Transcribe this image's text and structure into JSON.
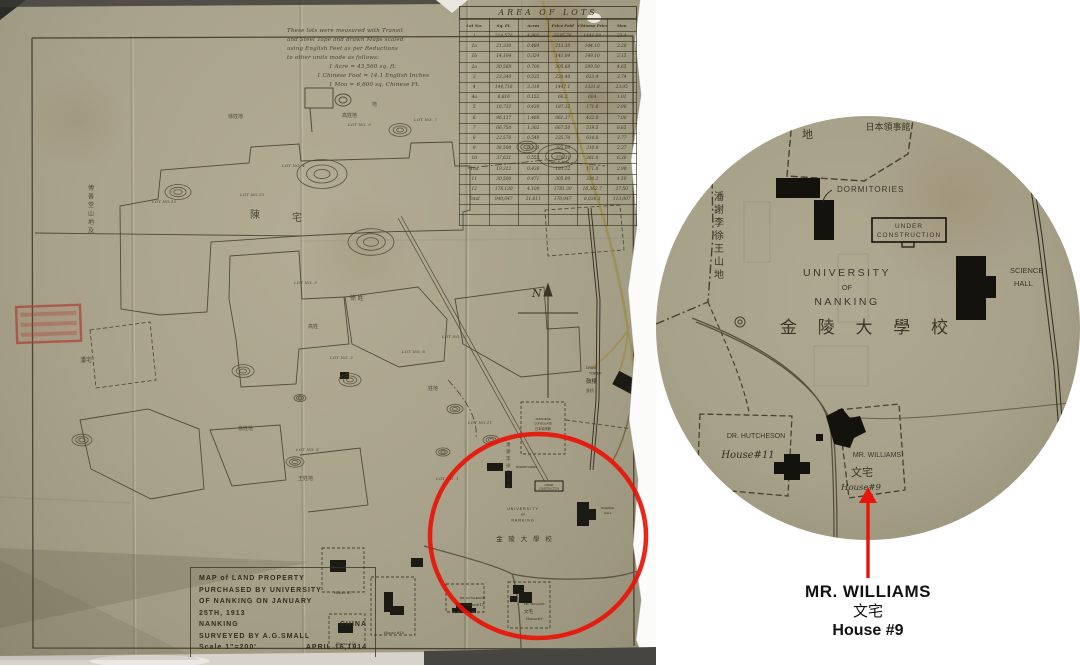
{
  "colors": {
    "paper": "#a9a28a",
    "ink": "#342f21",
    "road_yellow": "#9a8c45",
    "annotation_red": "#e8140c",
    "stamp_red": "#a8443a",
    "background": "#ffffff",
    "caption_text": "#111111"
  },
  "map_photo": {
    "notes": {
      "lines": [
        "These lots were measured with Transit",
        "and Steel Tape and drawn Maps scaled",
        "using English Feet as per Reductions",
        "to other units made as follows:",
        "1 Acre = 43,560 sq. ft.",
        "1 Chinese Foot = 14.1 English Inches",
        "1 Mou = 6,600 sq. Chinese Ft."
      ]
    },
    "table": {
      "title": "AREA OF LOTS",
      "headers": [
        "Lot No.",
        "Sq. Ft.",
        "Acres",
        "Price Paid",
        "Chinese Price",
        "Mou"
      ],
      "rows": [
        [
          "1",
          "214,576",
          "4.905",
          "2145.76",
          "1441.00",
          "23.4"
        ],
        [
          "1a",
          "21,330",
          "0.484",
          "213.30",
          "144.10",
          "3.28"
        ],
        [
          "1b",
          "14,104",
          "0.324",
          "141.04",
          "149.10",
          "2.15"
        ],
        [
          "2a",
          "30,568",
          "0.700",
          "305.68",
          "209.50",
          "4.65"
        ],
        [
          "3",
          "23,340",
          "0.535",
          "233.40",
          "613.4",
          "3.74"
        ],
        [
          "4",
          "144,716",
          "3.318",
          "1447.1",
          "1331.8",
          "23.05"
        ],
        [
          "4a",
          "6,616",
          "0.152",
          "66.2",
          "604",
          "1.01"
        ],
        [
          "5",
          "18,732",
          "0.430",
          "187.32",
          "171.6",
          "2.96"
        ],
        [
          "6",
          "96,137",
          "1.460",
          "961.37",
          "432.0",
          "7.00"
        ],
        [
          "7",
          "66,750",
          "1.302",
          "667.50",
          "519.5",
          "8.65"
        ],
        [
          "8",
          "23,570",
          "0.540",
          "235.70",
          "614.8",
          "3.77"
        ],
        [
          "9",
          "38,500",
          "0.333",
          "385.00",
          "310.0",
          "2.37"
        ],
        [
          "10",
          "37,631",
          "0.552",
          "376.31",
          "361.0",
          "6.30"
        ],
        [
          "10a",
          "19,312",
          "0.436",
          "193.12",
          "171.0",
          "2.90"
        ],
        [
          "11",
          "30,500",
          "0.471",
          "305.00",
          "330.2",
          "4.50"
        ],
        [
          "12",
          "178,130",
          "4.100",
          "1781.30",
          "16,362.7",
          "27.50"
        ],
        [
          "Total",
          "940,047",
          "21.611",
          "170,047",
          "8,036.3",
          "113,007"
        ],
        [
          "",
          "",
          "",
          "",
          "",
          ""
        ],
        [
          "",
          "",
          "",
          "",
          "",
          ""
        ]
      ]
    },
    "title_block": {
      "line1": "MAP of LAND PROPERTY",
      "line2": "PURCHASED BY UNIVERSITY",
      "line3": "OF NANKING ON JANUARY",
      "line4": "25TH, 1913",
      "place_left": "NANKING",
      "place_right": "CHINA",
      "line6": "SURVEYED BY A.G.SMALL",
      "scale": "Scale 1\"=200'",
      "date": "APRIL 16,1914"
    },
    "compass": "N",
    "labels": {
      "dormitories": "DORMITORIES",
      "under_construction_1": "UNDER",
      "under_construction_2": "CONSTRUCTION",
      "university_1": "UNIVERSITY",
      "university_2": "OF",
      "university_3": "NANKING",
      "university_cjk": "金 陵 大 學 校",
      "science_1": "SCIENCE",
      "science_2": "HALL",
      "hutcheson_1": "DR. HUTCHESON",
      "hutcheson_2": "House#11",
      "williams_1": "MR. WILLIAMS",
      "williams_cjk": "文宅",
      "williams_2": "House#9",
      "consulate_1": "JAPANESE",
      "consulate_2": "CONSULATE",
      "consulate_cjk": "日本領事館",
      "drum_1": "DRUM",
      "drum_2": "TOWER",
      "drum_cjk": "鼓樓",
      "hill_area_cjk": "潘謝李徐王山地",
      "di": "地",
      "house7": "House #7",
      "house10": "House #10",
      "house16": "House #16"
    },
    "lot_labels": [
      {
        "t": "LOT NO.10",
        "x": 152,
        "y": 203
      },
      {
        "t": "LOT NO.13",
        "x": 240,
        "y": 196
      },
      {
        "t": "LOT NO. 4",
        "x": 282,
        "y": 167
      },
      {
        "t": "LOT NO. 9",
        "x": 348,
        "y": 126
      },
      {
        "t": "LOT NO. 7",
        "x": 414,
        "y": 121
      },
      {
        "t": "LOT NO. 3",
        "x": 294,
        "y": 284
      },
      {
        "t": "LOT NO. 5",
        "x": 442,
        "y": 338
      },
      {
        "t": "LOT NO. 8",
        "x": 402,
        "y": 353
      },
      {
        "t": "LOT NO. 2",
        "x": 330,
        "y": 359
      },
      {
        "t": "LOT NO.11",
        "x": 468,
        "y": 424
      },
      {
        "t": "LOT NO. 1",
        "x": 436,
        "y": 480
      },
      {
        "t": "LOT NO. 6",
        "x": 296,
        "y": 451
      }
    ],
    "cjk_scatter": [
      {
        "t": "傅善堂山地及",
        "x": 88,
        "y": 190,
        "v": true,
        "s": 6
      },
      {
        "t": "陳",
        "x": 250,
        "y": 218,
        "s": 10
      },
      {
        "t": "宅",
        "x": 292,
        "y": 221,
        "s": 10
      },
      {
        "t": "徐姓地",
        "x": 228,
        "y": 118,
        "s": 5
      },
      {
        "t": "高姓地",
        "x": 342,
        "y": 117,
        "s": 5
      },
      {
        "t": "地",
        "x": 372,
        "y": 106,
        "s": 5
      },
      {
        "t": "徐 姓",
        "x": 350,
        "y": 300,
        "s": 6
      },
      {
        "t": "高姓",
        "x": 308,
        "y": 328,
        "s": 5
      },
      {
        "t": "潘宅",
        "x": 80,
        "y": 362,
        "s": 6
      },
      {
        "t": "徐姓地",
        "x": 238,
        "y": 430,
        "s": 5
      },
      {
        "t": "王姓地",
        "x": 298,
        "y": 480,
        "s": 5
      },
      {
        "t": "姓地",
        "x": 428,
        "y": 390,
        "s": 5
      },
      {
        "t": "潘謝李徐王山地",
        "x": 506,
        "y": 446,
        "v": true,
        "s": 4.5
      },
      {
        "t": "鉄桥",
        "x": 586,
        "y": 392,
        "s": 4
      }
    ]
  },
  "caption": {
    "line1": "MR. WILLIAMS",
    "line2": "文宅",
    "line3": "House #9"
  }
}
